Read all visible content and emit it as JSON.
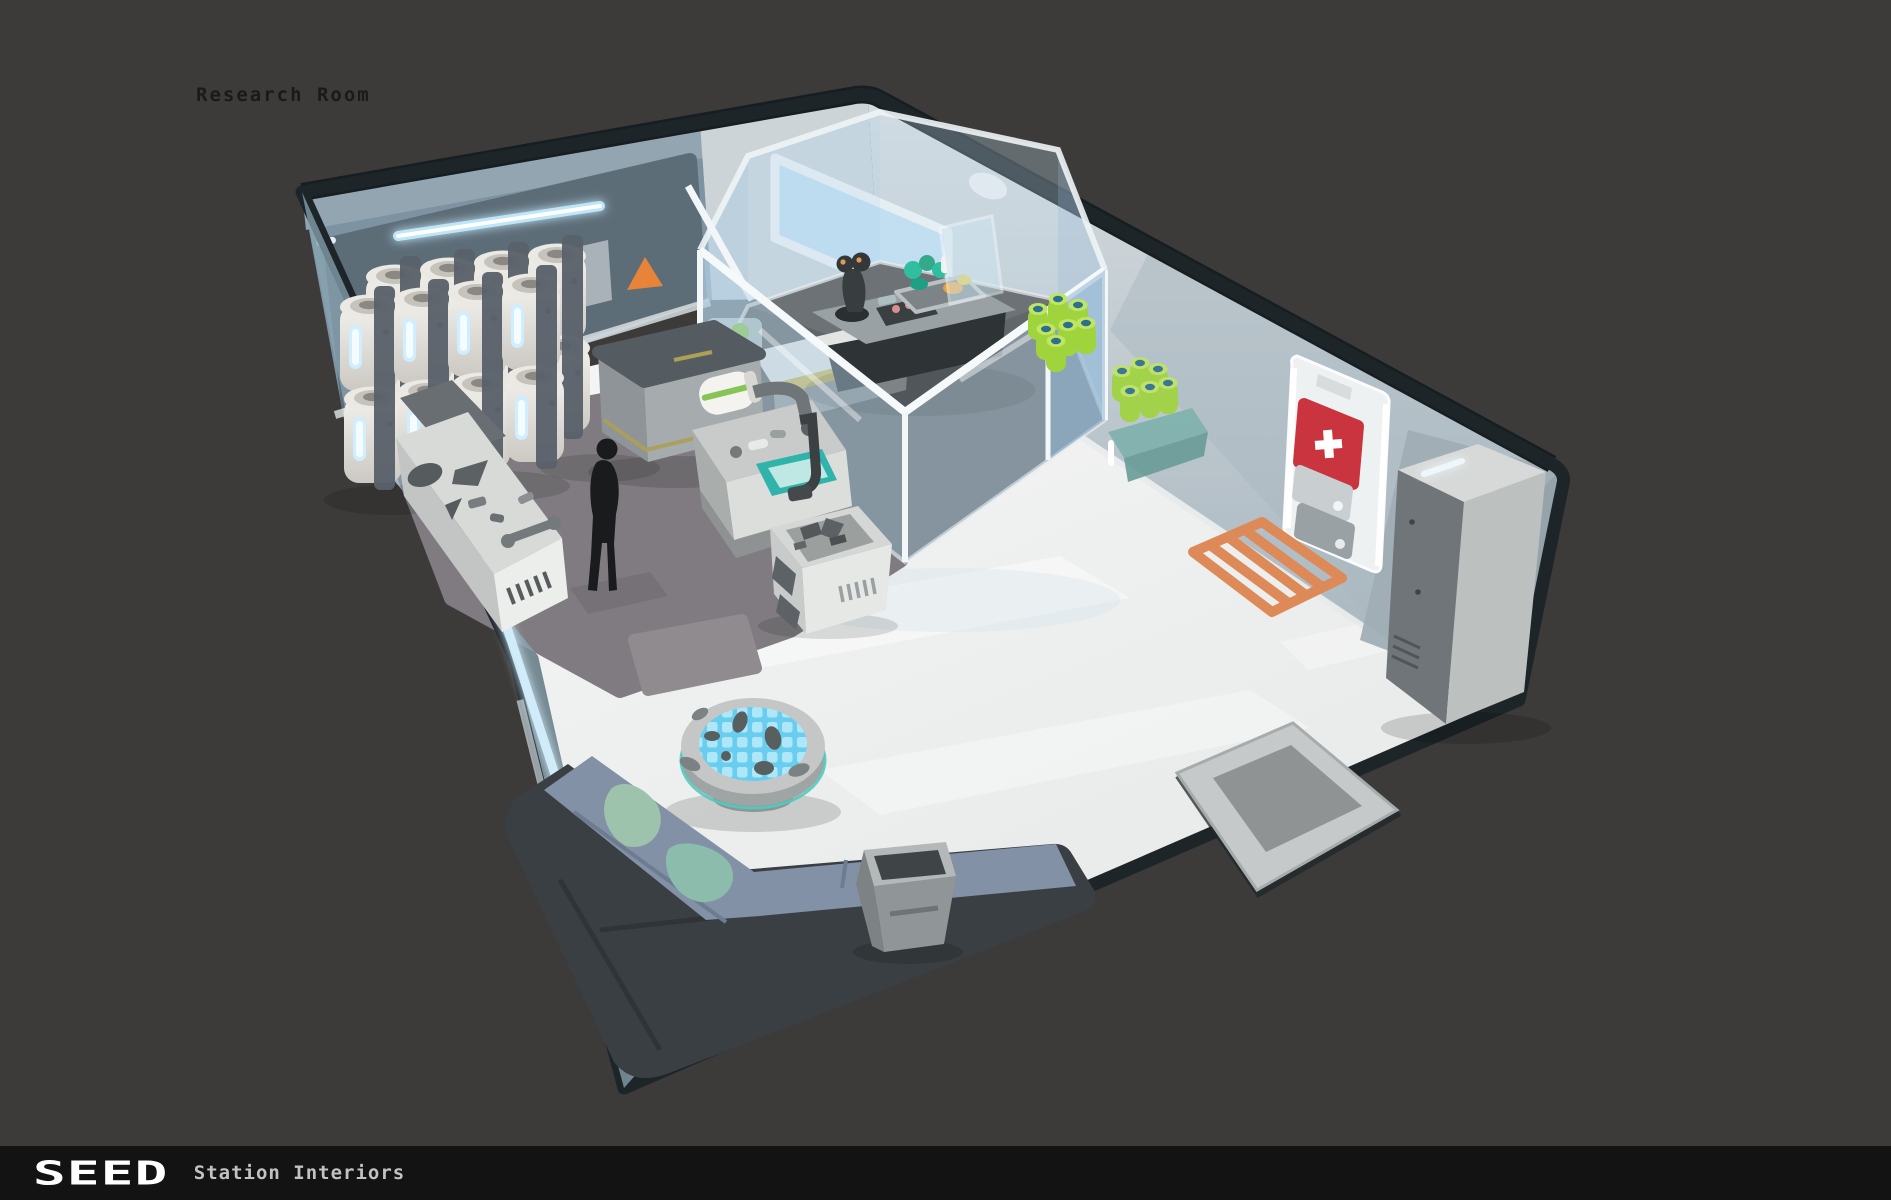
{
  "page": {
    "background_color": "#3c3b39"
  },
  "header": {
    "title": "Research Room"
  },
  "footer": {
    "logo": "SEED",
    "subtitle": "Station Interiors"
  },
  "palette": {
    "outline": "#1d2529",
    "wall_left": "#7e93a1",
    "wall_left_panel": "#5d6d78",
    "wall_right": "#c9d1d6",
    "window_glass": "#c2e0f4",
    "lab_glass": "#b4d0e4",
    "floor": "#f2f3f2",
    "floor_mat": "#7f7b80",
    "warning_orange": "#e8833a",
    "hazard_orange": "#dd8a58",
    "teal_accent": "#2fb3aa",
    "specimen_green": "#a5d93f",
    "sofa_cushion": "#8291a5",
    "sofa_shell": "#3a3f43",
    "blanket_sage": "#9dc3ad",
    "table_screen": "#7ed2ef",
    "medical_red": "#c9343e",
    "canister_white": "#efede8",
    "glow_blue": "#d6f1ff",
    "footer_background": "#141313",
    "title_color": "#1a1a1a",
    "footer_text": "#c2c2c2"
  },
  "scene": {
    "label": "Research Room",
    "objects": [
      "cryo-canisters",
      "wall-led-strip",
      "warning-triangle-sign",
      "wall-panel",
      "storage-crate",
      "workbench-with-tools",
      "standing-figure",
      "lab-workstation",
      "analysis-machine",
      "glass-lab-enclosure",
      "control-console",
      "joystick",
      "terrarium-tray",
      "specimen-cluster",
      "specimen-tray",
      "shelf-specimens",
      "wall-window",
      "ceiling-light",
      "medical-cabinet",
      "first-aid-box",
      "storage-locker",
      "hazard-floor-marking",
      "round-display-table",
      "corner-sofa",
      "waste-bin",
      "entrance-mat"
    ]
  }
}
